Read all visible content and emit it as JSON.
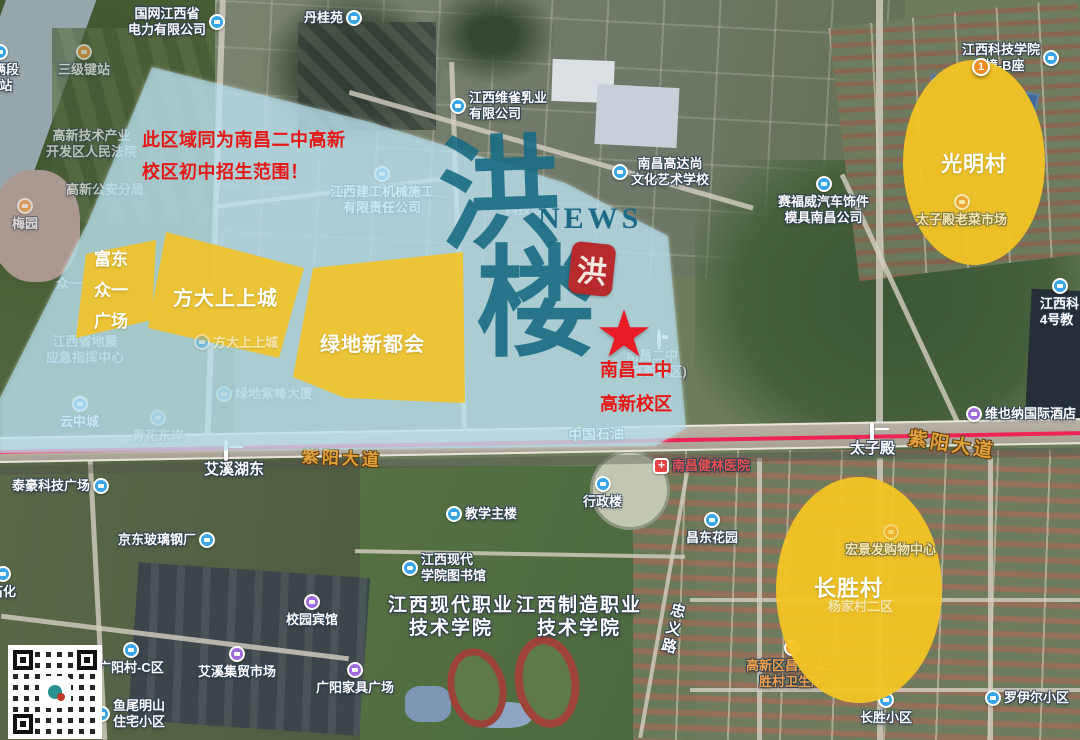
{
  "overlay": {
    "notice": {
      "line1": "此区域同为南昌二中高新",
      "line2": "校区初中招生范围！"
    },
    "school": {
      "line1": "南昌二中",
      "line2": "高新校区",
      "star": "★"
    },
    "zones": {
      "fudong": {
        "line1": "富东",
        "line2": "众一",
        "line3": "广场"
      },
      "fangda": {
        "label": "方大上上城"
      },
      "lvdi": {
        "label": "绿地新都会"
      },
      "guangming": {
        "label": "光明村"
      },
      "changsheng": {
        "label": "长胜村"
      }
    },
    "colors": {
      "zone_blue": "#a9d9ea",
      "zone_yellow": "#f0c32c",
      "annotation_red": "#e81717",
      "metro_line": "#e3234e"
    }
  },
  "watermark": {
    "char1": "洪",
    "char2": "楼",
    "news": "NEWS",
    "seal_char": "洪",
    "color": "#1c6e84",
    "seal_color": "#b72a2d"
  },
  "roads": {
    "ziyang": "紫阳大道",
    "petro": "中国石油",
    "zhongyi": "忠义路"
  },
  "stations": {
    "aixihudong": "艾溪湖东",
    "taizidian": "太子殿"
  },
  "pois": {
    "guowang": {
      "line1": "国网江西省",
      "line2": "电力有限公司"
    },
    "danguiyuan": {
      "label": "丹桂苑"
    },
    "sanjijian": {
      "label": "三级键站"
    },
    "cheliangduan": {
      "line1": "车辆段",
      "line2": "场站"
    },
    "court": {
      "line1": "高新技术产业",
      "line2": "开发区人民法院"
    },
    "police": {
      "label": "高新公安分局"
    },
    "meiyuan": {
      "label": "梅园"
    },
    "weique": {
      "line1": "江西维雀乳业",
      "line2": "有限公司"
    },
    "jiangong": {
      "line1": "江西建工机械施工",
      "line2": "有限责任公司"
    },
    "gaodashang": {
      "line1": "南昌高达尚",
      "line2": "文化艺术学校"
    },
    "keji3": {
      "line1": "江西科技学院",
      "line2": "3幢-B座",
      "marker": "1"
    },
    "keji4": {
      "line1": "江西科",
      "line2": "4号教"
    },
    "saifuwei": {
      "line1": "赛福威汽车饰件",
      "line2": "模具南昌公司"
    },
    "taizidian_market": {
      "label": "太子殿老菜市场"
    },
    "zhongyi_plaza": {
      "label": "众一广场"
    },
    "fangda_map": {
      "label": "方大上上城"
    },
    "dizhen": {
      "line1": "江西省地震",
      "line2": "应急指挥中心"
    },
    "zifeng": {
      "label": "绿地紫峰大厦"
    },
    "yunzhongcheng": {
      "label": "云中城"
    },
    "qinghua": {
      "label": "青花东岸"
    },
    "kejiyuan": {
      "label": "科技园"
    },
    "school_map": {
      "line1": "南昌二中",
      "line2": "(高新校区)"
    },
    "taihao": {
      "label": "泰豪科技广场"
    },
    "jingdong": {
      "label": "京东玻璃钢厂"
    },
    "jiaoxue": {
      "label": "教学主楼"
    },
    "xingzheng": {
      "label": "行政楼"
    },
    "hospital": {
      "label": "南昌健林医院"
    },
    "changdong": {
      "label": "昌东花园"
    },
    "library": {
      "line1": "江西现代",
      "line2": "学院图书馆"
    },
    "xiandai_college": {
      "line1": "江西现代职业",
      "line2": "技术学院"
    },
    "zhizao_college": {
      "line1": "江西制造职业",
      "line2": "技术学院"
    },
    "hotel_xiaoyuan": {
      "label": "校园宾馆"
    },
    "aixi_market": {
      "label": "艾溪集贸市场"
    },
    "guangyang_c": {
      "label": "广阳村-C区"
    },
    "yuwei": {
      "line1": "鱼尾明山",
      "line2": "住宅小区"
    },
    "guangyang_furniture": {
      "label": "广阳家具广场"
    },
    "shihua": {
      "label": "石化"
    },
    "vienna": {
      "label": "维也纳国际酒店"
    },
    "hongjing": {
      "label": "宏景发购物中心"
    },
    "yangjiacun": {
      "label": "杨家村二区"
    },
    "weishengsuo": {
      "line1": "高新区昌东镇长",
      "line2": "胜村卫生所"
    },
    "changsheng_xq": {
      "label": "长胜小区"
    },
    "luoyier": {
      "label": "罗伊尔小区"
    }
  }
}
